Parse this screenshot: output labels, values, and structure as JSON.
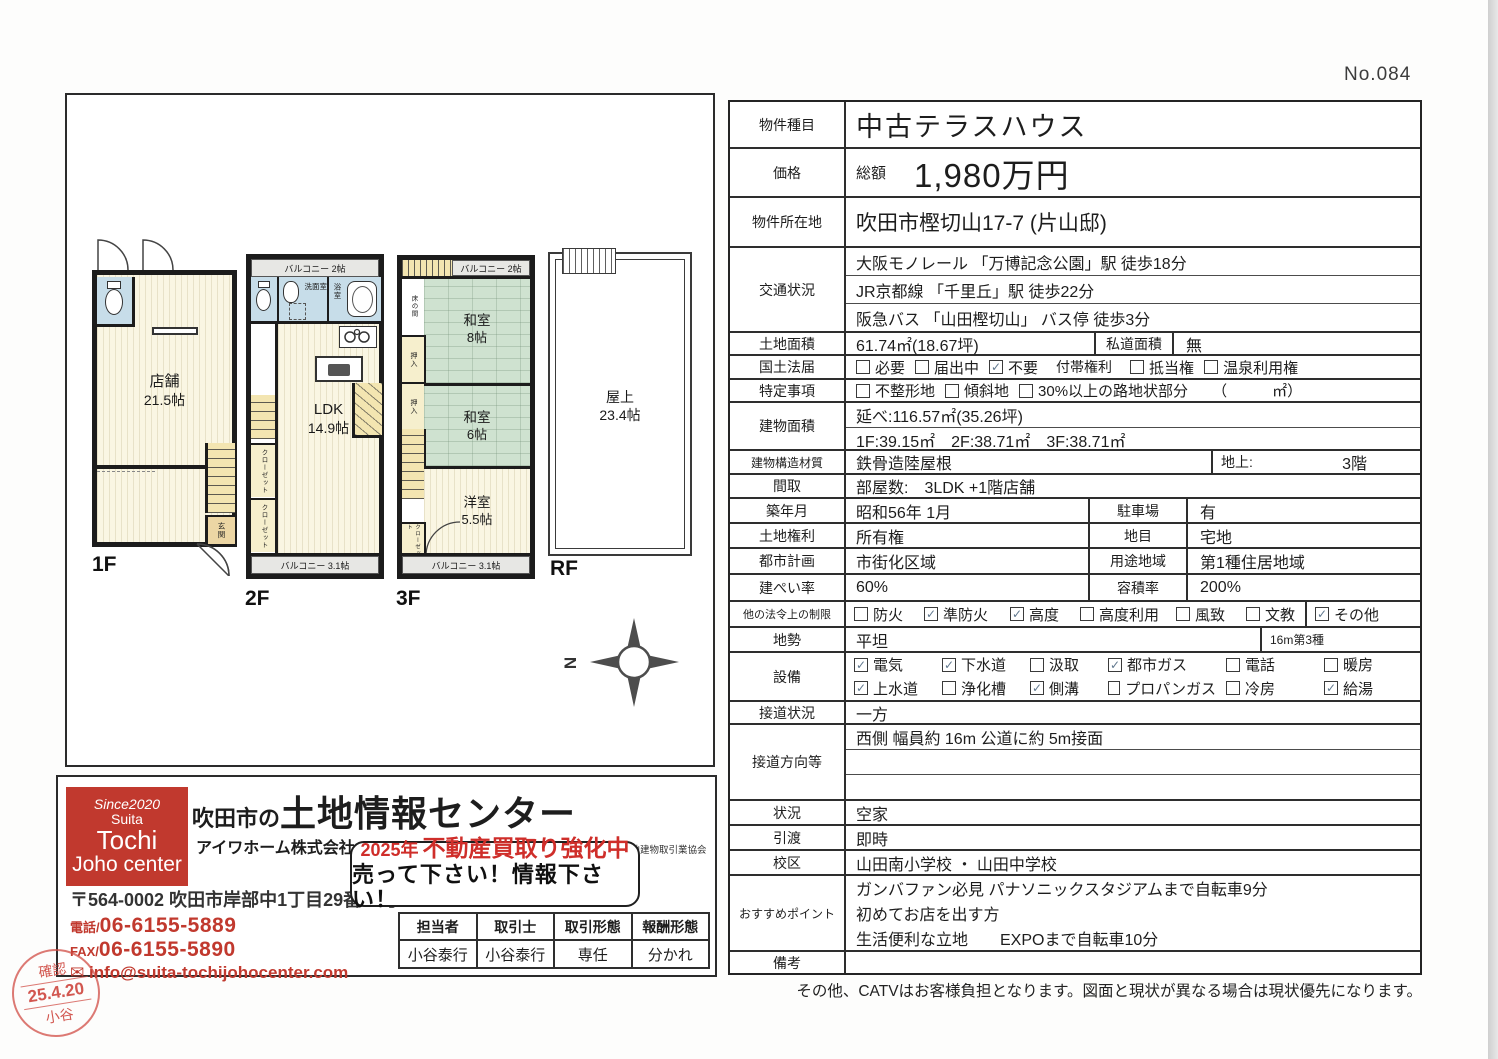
{
  "page": {
    "doc_no": "No.084",
    "footer_note": "その他、CATVはお客様負担となります。図面と現状が異なる場合は現状優先になります。"
  },
  "colors": {
    "accent_red": "#c1392e",
    "stamp_red": "#d04a42",
    "tatami_green": "#cfe2d0",
    "wet_blue": "#c7dde9",
    "stair_yellow": "#f3e5b1",
    "balcony_gray": "#e7e7e4",
    "wall_black": "#1c1c1c"
  },
  "fp": {
    "compass": "N",
    "f1": {
      "tag": "1F",
      "room": "店舗",
      "size": "21.5帖",
      "genkan": "玄関"
    },
    "f2": {
      "tag": "2F",
      "bal_top": "バルコニー 2帖",
      "bal_btm": "バルコニー 3.1帖",
      "senmen": "洗面室",
      "bath": "浴室",
      "room": "LDK",
      "size": "14.9帖",
      "clo": "クローゼット"
    },
    "f3": {
      "tag": "3F",
      "bal_top": "バルコニー 2帖",
      "bal_btm": "バルコニー 3.1帖",
      "toko": "床の間",
      "oshi": "押入",
      "w8": "和室",
      "w8s": "8帖",
      "w6": "和室",
      "w6s": "6帖",
      "yo": "洋室",
      "yos": "5.5帖",
      "clo": "クローゼット"
    },
    "rf": {
      "tag": "RF",
      "room": "屋上",
      "size": "23.4帖"
    }
  },
  "t": {
    "r1": {
      "k": "物件種目",
      "v": "中古テラスハウス"
    },
    "r2": {
      "k": "価格",
      "pre": "総額",
      "v": "1,980万円"
    },
    "r3": {
      "k": "物件所在地",
      "v": "吹田市樫切山17-7 (片山邸)"
    },
    "r4": {
      "k": "交通状況",
      "l1": "大阪モノレール 「万博記念公園」駅 徒歩18分",
      "l2": "JR京都線 「千里丘」駅 徒歩22分",
      "l3": "阪急バス 「山田樫切山」 バス停 徒歩3分"
    },
    "r5": {
      "k": "土地面積",
      "v": "61.74㎡(18.67坪)",
      "k2": "私道面積",
      "v2": "無"
    },
    "r6": {
      "k": "国土法届",
      "o": [
        {
          "m": "",
          "l": "必要"
        },
        {
          "m": "",
          "l": "届出中"
        },
        {
          "m": "✓",
          "l": "不要"
        }
      ],
      "mid": "付帯権利",
      "o2": [
        {
          "m": "",
          "l": "抵当権"
        },
        {
          "m": "",
          "l": "温泉利用権"
        }
      ]
    },
    "r7": {
      "k": "特定事項",
      "o": [
        {
          "m": "",
          "l": "不整形地"
        },
        {
          "m": "",
          "l": "傾斜地"
        },
        {
          "m": "",
          "l": "30%以上の路地状部分"
        }
      ],
      "suf": "（　　　㎡）"
    },
    "r8": {
      "k": "建物面積",
      "l1": "延べ:116.57㎡(35.26坪)",
      "l2": "1F:39.15㎡　2F:38.71㎡　3F:38.71㎡"
    },
    "r9": {
      "k": "建物構造材質",
      "v": "鉄骨造陸屋根",
      "k2": "地上:",
      "v2": "3階"
    },
    "r10": {
      "k": "間取",
      "v": "部屋数:　3LDK +1階店舗"
    },
    "r11": {
      "k": "築年月",
      "v": "昭和56年 1月",
      "k2": "駐車場",
      "v2": "有"
    },
    "r12": {
      "k": "土地権利",
      "v": "所有権",
      "k2": "地目",
      "v2": "宅地"
    },
    "r13": {
      "k": "都市計画",
      "v": "市街化区域",
      "k2": "用途地域",
      "v2": "第1種住居地域"
    },
    "r14": {
      "k": "建ぺい率",
      "v": "60%",
      "k2": "容積率",
      "v2": "200%"
    },
    "r15": {
      "k": "他の法令上の制限",
      "o": [
        {
          "m": "",
          "l": "防火"
        },
        {
          "m": "✓",
          "l": "準防火"
        },
        {
          "m": "✓",
          "l": "高度"
        },
        {
          "m": "",
          "l": "高度利用"
        },
        {
          "m": "",
          "l": "風致"
        },
        {
          "m": "",
          "l": "文教"
        }
      ],
      "r": {
        "m": "✓",
        "l": "その他"
      }
    },
    "r16": {
      "k": "地勢",
      "v": "平坦",
      "note": "16m第3種"
    },
    "r17": {
      "k": "設備",
      "o1": [
        {
          "m": "✓",
          "l": "電気"
        },
        {
          "m": "✓",
          "l": "下水道"
        },
        {
          "m": "",
          "l": "汲取"
        },
        {
          "m": "✓",
          "l": "都市ガス"
        },
        {
          "m": "",
          "l": "電話"
        },
        {
          "m": "",
          "l": "暖房"
        }
      ],
      "o2": [
        {
          "m": "✓",
          "l": "上水道"
        },
        {
          "m": "",
          "l": "浄化槽"
        },
        {
          "m": "✓",
          "l": "側溝"
        },
        {
          "m": "",
          "l": "プロパンガス"
        },
        {
          "m": "",
          "l": "冷房"
        },
        {
          "m": "✓",
          "l": "給湯"
        }
      ]
    },
    "r18": {
      "k": "接道状況",
      "v": "一方"
    },
    "r19": {
      "k": "接道方向等",
      "l1": "西側 幅員約 16m 公道に約 5m接面",
      "l2": "",
      "l3": ""
    },
    "r20": {
      "k": "状況",
      "v": "空家"
    },
    "r21": {
      "k": "引渡",
      "v": "即時"
    },
    "r22": {
      "k": "校区",
      "v": "山田南小学校 ・ 山田中学校"
    },
    "r23": {
      "k": "おすすめポイント",
      "l1": "ガンバファン必見 パナソニックスタジアムまで自転車9分",
      "l2": "初めてお店を出す方",
      "l3": "生活便利な立地　　EXPOまで自転車10分"
    },
    "r24": {
      "k": "備考",
      "v": ""
    }
  },
  "co": {
    "logo": [
      "Since2020",
      "Suita",
      "Tochi",
      "Joho center"
    ],
    "t_pre": "吹田市の",
    "t_main": "土地情報センター",
    "name": "アイワホーム株式会社",
    "lic": "宅建業免許／大阪府知事 (7) 第42509号　所属団体名／大阪府宅地建物取引業協会",
    "addr": "〒564-0002 吹田市岸部中1丁目29番13号",
    "tel_k": "電話/",
    "tel": "06-6155-5889",
    "fax_k": "FAX/",
    "fax": "06-6155-5890",
    "mail_icon": "✉",
    "mail": "info@suita-tochijohocenter.com",
    "b_year": "2025年",
    "b1": "不動産買取り強化中",
    "b2": "売って下さい！情報下さい！",
    "mt_h": [
      "担当者",
      "取引士",
      "取引形態",
      "報酬形態"
    ],
    "mt_v": [
      "小谷泰行",
      "小谷泰行",
      "専任",
      "分かれ"
    ],
    "stamp": {
      "a": "確認",
      "b": "25.4.20",
      "c": "小谷"
    }
  }
}
